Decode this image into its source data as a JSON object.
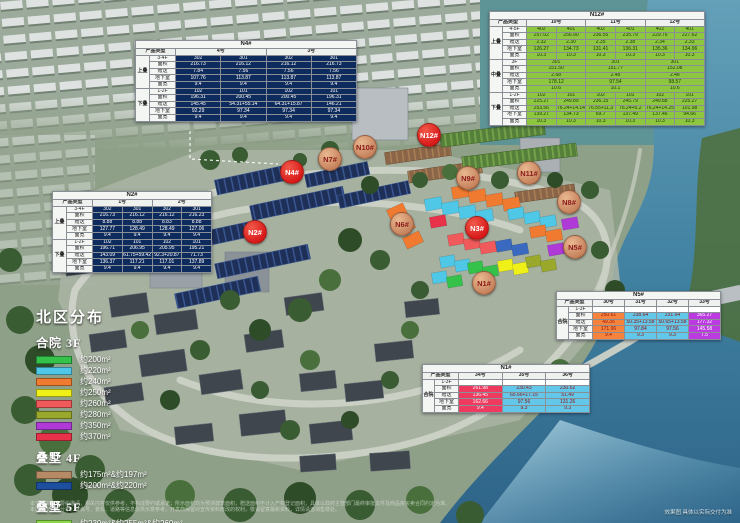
{
  "page": {
    "title": "北区分布",
    "corner_note": "效果图 具体以实际交付为准"
  },
  "footer": {
    "disclaimer1": "本宣传资料为要约邀请，相关内容仅供参考，不构成要约或承诺；所示面积均为预测建筑面积，赠送面积不计入产权登记面积，具体以政府主管部门最终审批文件及商品房买卖合同约定为准。",
    "disclaimer2": "本图所示户型分布、楼栋号、景观、道路等信息仅供示意参考，开发商保留对宣传资料修改的权利，敬请留意最新资料，详情请咨询售楼处。"
  },
  "legend": {
    "title": "北区分布",
    "groups": [
      {
        "label": "合院 3F",
        "items": [
          {
            "color": "#35c24a",
            "label": "约200m²"
          },
          {
            "color": "#4fc8e8",
            "label": "约220m²"
          },
          {
            "color": "#f07a30",
            "label": "约240m²"
          },
          {
            "color": "#eef018",
            "label": "约250m²"
          },
          {
            "color": "#f05a5a",
            "label": "约260m²"
          },
          {
            "color": "#9aa82c",
            "label": "约280m²"
          },
          {
            "color": "#b03ad8",
            "label": "约350m²"
          },
          {
            "color": "#e8324a",
            "label": "约370m²"
          }
        ]
      },
      {
        "label": "叠墅 4F",
        "items": [
          {
            "color": "#b58a65",
            "label": "约175m²&约197m²"
          },
          {
            "color": "#1d4f9e",
            "label": "约200m²&约220m²"
          }
        ]
      },
      {
        "label": "叠墅 5F",
        "items": [
          {
            "color": "#8ad84a",
            "label": "约230m²&约255m²&约260m²"
          }
        ]
      }
    ]
  },
  "markers": [
    {
      "id": "n2",
      "label": "N2#",
      "x": 255,
      "y": 232,
      "type": "red"
    },
    {
      "id": "n4",
      "label": "N4#",
      "x": 292,
      "y": 172,
      "type": "red"
    },
    {
      "id": "n7",
      "label": "N7#",
      "x": 330,
      "y": 159,
      "type": "tan"
    },
    {
      "id": "n10",
      "label": "N10#",
      "x": 365,
      "y": 147,
      "type": "tan"
    },
    {
      "id": "n12",
      "label": "N12#",
      "x": 429,
      "y": 135,
      "type": "red"
    },
    {
      "id": "n9",
      "label": "N9#",
      "x": 468,
      "y": 178,
      "type": "tan"
    },
    {
      "id": "n11",
      "label": "N11#",
      "x": 529,
      "y": 173,
      "type": "tan"
    },
    {
      "id": "n6",
      "label": "N6#",
      "x": 402,
      "y": 224,
      "type": "tan"
    },
    {
      "id": "n3",
      "label": "N3#",
      "x": 477,
      "y": 228,
      "type": "red"
    },
    {
      "id": "n8",
      "label": "N8#",
      "x": 569,
      "y": 202,
      "type": "tan"
    },
    {
      "id": "n5",
      "label": "N5#",
      "x": 575,
      "y": 247,
      "type": "tan"
    },
    {
      "id": "n1",
      "label": "N1#",
      "x": 484,
      "y": 283,
      "type": "tan"
    }
  ],
  "colors": {
    "marker_red": "#d81a1a",
    "marker_tan": "#c4805a",
    "table_navy": "#0e2b5e",
    "table_green": "#8dc63f"
  },
  "tables": [
    {
      "id": "n4",
      "title": "N4#",
      "style": "navy",
      "header_label": "产品类型",
      "label_w": [
        14,
        26
      ],
      "cols": [
        {
          "label": "4号",
          "span": 2
        },
        {
          "label": "3号",
          "span": 2
        }
      ],
      "groups": [
        {
          "label": "上叠",
          "rows": [
            {
              "label": "3-4F",
              "cells": [
                "302",
                "301",
                "302",
                "301"
              ]
            },
            {
              "label": "面积",
              "cells": [
                "216.73",
                "216.12",
                "216.12",
                "216.73"
              ]
            },
            {
              "label": "赠送",
              "cells": [
                "7.84",
                "7.56",
                "7.56",
                "7.56"
              ]
            },
            {
              "label": "地下室",
              "cells": [
                "107.76",
                "113.87",
                "113.87",
                "113.87"
              ]
            },
            {
              "label": "面宽",
              "cells": [
                "9.4",
                "9.4",
                "9.4",
                "9.4"
              ]
            }
          ]
        },
        {
          "label": "下叠",
          "rows": [
            {
              "label": "1-2F",
              "cells": [
                "102",
                "101",
                "102",
                "101"
              ]
            },
            {
              "label": "面积",
              "cells": [
                "196.31",
                "200.45",
                "200.45",
                "196.31"
              ]
            },
            {
              "label": "赠送",
              "cells": [
                "145.45",
                "54.31+55.14",
                "64.31+15.87",
                "146.21"
              ]
            },
            {
              "label": "地下室",
              "cells": [
                "92.29",
                "97.34",
                "97.34",
                "97.34"
              ]
            },
            {
              "label": "面宽",
              "cells": [
                "9.4",
                "9.4",
                "9.4",
                "9.4"
              ]
            }
          ]
        }
      ]
    },
    {
      "id": "n12",
      "title": "N12#",
      "style": "green",
      "header_label": "产品类型",
      "label_w": [
        13,
        24
      ],
      "cols": [
        {
          "label": "10号",
          "span": 2
        },
        {
          "label": "11号",
          "span": 2
        },
        {
          "label": "12号",
          "span": 2
        }
      ],
      "groups": [
        {
          "label": "上叠",
          "rows": [
            {
              "label": "4-5F",
              "cells": [
                "402",
                "401",
                "402",
                "401",
                "402",
                "401"
              ]
            },
            {
              "label": "面积",
              "cells": [
                "257.02",
                "256.90",
                "236.55",
                "235.79",
                "229.76",
                "227.62"
              ]
            },
            {
              "label": "赠送",
              "cells": [
                "2.32",
                "2.30",
                "2.35",
                "2.38",
                "2.34",
                "2.33"
              ]
            },
            {
              "label": "地下室",
              "cells": [
                "126.27",
                "134.73",
                "131.41",
                "136.31",
                "135.36",
                "134.96"
              ]
            },
            {
              "label": "面宽",
              "cells": [
                "10.3",
                "10.3",
                "10.3",
                "10.3",
                "10.3",
                "10.3"
              ]
            }
          ]
        },
        {
          "label": "中叠",
          "rows": [
            {
              "label": "3F",
              "cells": [
                {
                  "v": "301",
                  "s": 2
                },
                {
                  "v": "301",
                  "s": 2
                },
                {
                  "v": "301",
                  "s": 2
                }
              ]
            },
            {
              "label": "面积",
              "cells": [
                {
                  "v": "151.50",
                  "s": 2
                },
                {
                  "v": "151.77",
                  "s": 2
                },
                {
                  "v": "152.08",
                  "s": 2
                }
              ]
            },
            {
              "label": "赠送",
              "cells": [
                {
                  "v": "2.68",
                  "s": 2
                },
                {
                  "v": "2.48",
                  "s": 2
                },
                {
                  "v": "2.48",
                  "s": 2
                }
              ]
            },
            {
              "label": "地下室",
              "cells": [
                {
                  "v": "178.12",
                  "s": 2
                },
                {
                  "v": "97.54",
                  "s": 2
                },
                {
                  "v": "98.57",
                  "s": 2
                }
              ]
            },
            {
              "label": "面宽",
              "cells": [
                {
                  "v": "10.6",
                  "s": 2
                },
                {
                  "v": "10.1",
                  "s": 2
                },
                {
                  "v": "10.6",
                  "s": 2
                }
              ]
            }
          ]
        },
        {
          "label": "下叠",
          "rows": [
            {
              "label": "1-2F",
              "cells": [
                "102",
                "101",
                "102",
                "101",
                "102",
                "101"
              ]
            },
            {
              "label": "面积",
              "cells": [
                "225.27",
                "249.89",
                "236.15",
                "245.79",
                "249.88",
                "225.27"
              ]
            },
            {
              "label": "赠送",
              "cells": [
                "253.56",
                "76.24+14.14",
                "76.55+11.3",
                "76.24+5.2",
                "76.24+14.25",
                "101.98"
              ]
            },
            {
              "label": "地下室",
              "cells": [
                "139.27",
                "134.73",
                "69.7",
                "137.49",
                "137.46",
                "94.66"
              ]
            },
            {
              "label": "面宽",
              "cells": [
                "10.3",
                "10.3",
                "10.3",
                "10.3",
                "10.3",
                "10.3"
              ]
            }
          ]
        }
      ]
    },
    {
      "id": "n2",
      "title": "N2#",
      "style": "navy",
      "header_label": "产品类型",
      "label_w": [
        14,
        26
      ],
      "cols": [
        {
          "label": "1号",
          "span": 2
        },
        {
          "label": "2号",
          "span": 2
        }
      ],
      "groups": [
        {
          "label": "上叠",
          "rows": [
            {
              "label": "3-4F",
              "cells": [
                "302",
                "301",
                "302",
                "301"
              ]
            },
            {
              "label": "面积",
              "cells": [
                "216.73",
                "216.12",
                "216.12",
                "216.23"
              ]
            },
            {
              "label": "赠送",
              "cells": [
                "8.88",
                "8.88",
                "8.83",
                "8.88"
              ]
            },
            {
              "label": "地下室",
              "cells": [
                "127.77",
                "128.49",
                "128.49",
                "127.06"
              ]
            },
            {
              "label": "面宽",
              "cells": [
                "9.4",
                "9.4",
                "9.4",
                "9.4"
              ]
            }
          ]
        },
        {
          "label": "下叠",
          "rows": [
            {
              "label": "1-2F",
              "cells": [
                "102",
                "101",
                "102",
                "101"
              ]
            },
            {
              "label": "面积",
              "cells": [
                "196.71",
                "206.95",
                "205.95",
                "195.21"
              ]
            },
            {
              "label": "赠送",
              "cells": [
                "143.09",
                "61.75+59.42",
                "92.3+20.87",
                "71.73"
              ]
            },
            {
              "label": "地下室",
              "cells": [
                "136.37",
                "117.21",
                "117.01",
                "137.89"
              ]
            },
            {
              "label": "面宽",
              "cells": [
                "9.4",
                "9.4",
                "9.4",
                "9.4"
              ]
            }
          ]
        }
      ]
    },
    {
      "id": "n5",
      "title": "N5#",
      "style": "white",
      "header_label": "产品类型",
      "label_w": [
        12,
        24
      ],
      "col_colors": [
        "#f5833b",
        "#62c7e8",
        "#62c7e8",
        "#bb3be0"
      ],
      "col_text": [
        "#8f1010",
        "#8f1010",
        "#8f1010",
        "#ffffff"
      ],
      "cols": [
        {
          "label": "30号",
          "span": 1
        },
        {
          "label": "31号",
          "span": 1
        },
        {
          "label": "32号",
          "span": 1
        },
        {
          "label": "33号",
          "span": 1
        }
      ],
      "groups": [
        {
          "label": "合院",
          "rows": [
            {
              "label": "1-3F",
              "plain": true,
              "cells": [
                "",
                "",
                "",
                ""
              ]
            },
            {
              "label": "面积",
              "cells": [
                "250.61",
                "238.64",
                "231.64",
                "365.27"
              ]
            },
            {
              "label": "赠送",
              "cells": [
                "49.35",
                "50.35+13.58",
                "50.65+13.58",
                "177.32"
              ]
            },
            {
              "label": "地下室",
              "cells": [
                "171.96",
                "97.84",
                "97.56",
                "145.58"
              ]
            },
            {
              "label": "面宽",
              "cells": [
                "9.4",
                "9.3",
                "9.3",
                "7.5"
              ]
            }
          ]
        }
      ]
    },
    {
      "id": "n1",
      "title": "N1#",
      "style": "white",
      "header_label": "产品类型",
      "label_w": [
        12,
        24
      ],
      "col_colors": [
        "#ed3a5e",
        "#62c7e8",
        "#62c7e8"
      ],
      "col_text": [
        "#ffffff",
        "#8f1010",
        "#8f1010"
      ],
      "cols": [
        {
          "label": "34号",
          "span": 1
        },
        {
          "label": "35号",
          "span": 1
        },
        {
          "label": "36号",
          "span": 1
        }
      ],
      "groups": [
        {
          "label": "合院",
          "rows": [
            {
              "label": "1-3F",
              "plain": true,
              "cells": [
                "",
                "",
                ""
              ]
            },
            {
              "label": "面积",
              "cells": [
                "261.98",
                "230.43",
                "230.62"
              ]
            },
            {
              "label": "赠送",
              "cells": [
                "136.45",
                "65.66+17.15",
                "51.49"
              ]
            },
            {
              "label": "地下室",
              "cells": [
                "162.66",
                "97.56",
                "131.26"
              ]
            },
            {
              "label": "面宽",
              "cells": [
                "9.4",
                "9.3",
                "9.3"
              ]
            }
          ]
        }
      ]
    }
  ]
}
